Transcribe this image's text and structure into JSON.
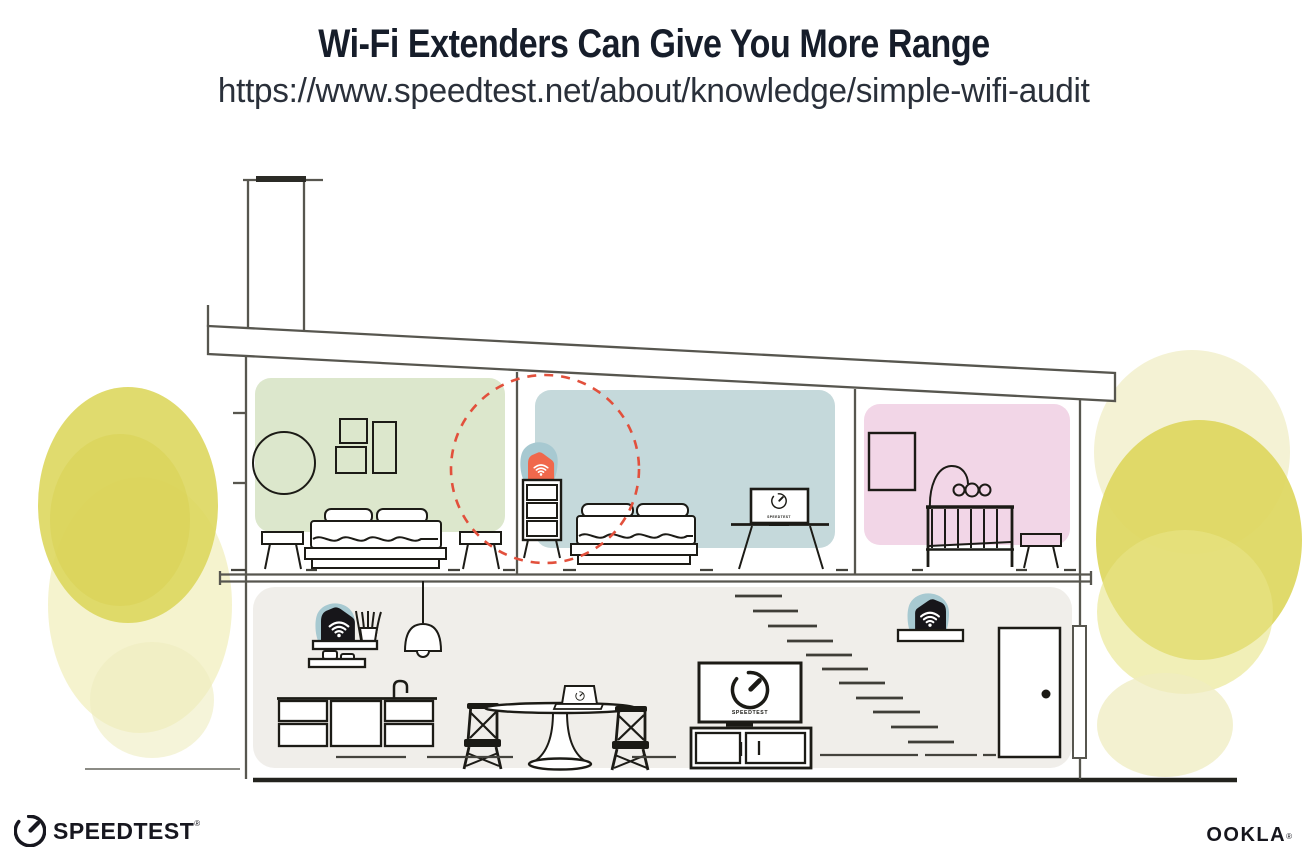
{
  "header": {
    "title": "Wi-Fi Extenders Can Give You More Range",
    "url": "https://www.speedtest.net/about/knowledge/simple-wifi-audit"
  },
  "footer": {
    "speedtest_wordmark": "SPEEDTEST",
    "speedtest_reg_mark": "®",
    "ookla_wordmark": "OOKLA",
    "ookla_reg_mark": "®"
  },
  "illustration": {
    "tv_screen_label": "SPEEDTEST",
    "colors": {
      "bedroom_green": "#dce7cc",
      "bedroom_blue": "#c5d9db",
      "nursery_pink": "#f2d6e7",
      "downstairs_gray": "#f0eeea",
      "extender_orange": "#f0684c",
      "router_black": "#17161a",
      "device_halo_teal": "#a7c9d1",
      "range_dashed_red": "#e2503c",
      "foliage_yellow": "#ddd75e"
    }
  }
}
